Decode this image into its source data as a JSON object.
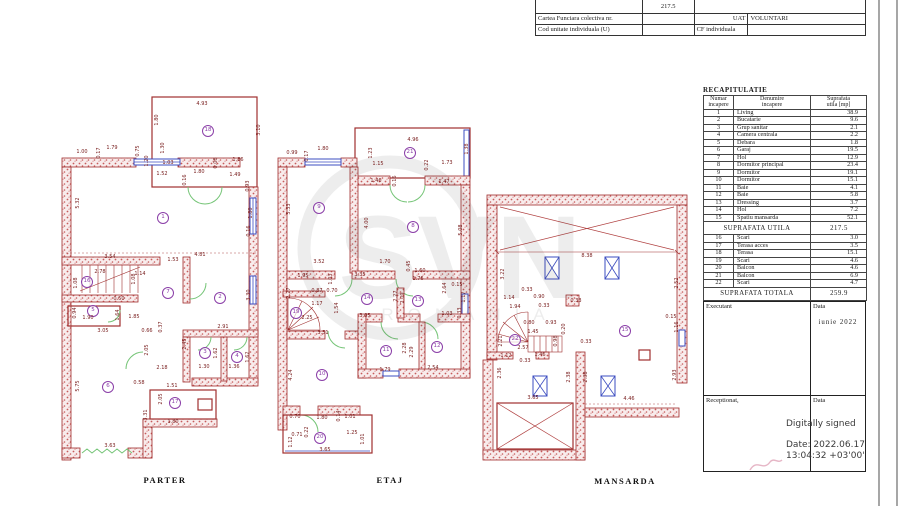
{
  "watermark": {
    "main": "SVN",
    "sub": "ROMANIA"
  },
  "top_table": {
    "area_value": "217.5",
    "row2": {
      "label": "Cartea Funciara colectiva nr.",
      "col2": "",
      "col3": "UAT",
      "col4": "VOLUNTARI"
    },
    "row3": {
      "label": "Cod unitate individuala (U)",
      "col2": "",
      "col3": "CF individuala",
      "col4": ""
    }
  },
  "recap": {
    "title": "RECAPITULATIE",
    "headers": [
      {
        "l1": "Numar",
        "l2": "incapere"
      },
      {
        "l1": "Denumire",
        "l2": "incapere"
      },
      {
        "l1": "Suprafata",
        "l2": "utila [mp]"
      }
    ],
    "rows": [
      [
        "1",
        "Living",
        "38.9"
      ],
      [
        "2",
        "Bucatarie",
        "9.6"
      ],
      [
        "3",
        "Grup sanitar",
        "2.1"
      ],
      [
        "4",
        "Camera centrala",
        "2.2"
      ],
      [
        "5",
        "Debara",
        "1.8"
      ],
      [
        "6",
        "Garaj",
        "19.5"
      ],
      [
        "7",
        "Hol",
        "12.9"
      ],
      [
        "8",
        "Dormitor principal",
        "23.4"
      ],
      [
        "9",
        "Dormitor",
        "19.1"
      ],
      [
        "10",
        "Dormitor",
        "15.1"
      ],
      [
        "11",
        "Baie",
        "4.1"
      ],
      [
        "12",
        "Baie",
        "5.8"
      ],
      [
        "13",
        "Dressing",
        "3.7"
      ],
      [
        "14",
        "Hol",
        "7.2"
      ],
      [
        "15",
        "Spatiu mansarda",
        "52.1"
      ]
    ],
    "subtotal_label": "SUPRAFATA UTILA",
    "subtotal_value": "217.5",
    "rows2": [
      [
        "16",
        "Scari",
        "3.0"
      ],
      [
        "17",
        "Terasa acces",
        "3.5"
      ],
      [
        "18",
        "Terasa",
        "15.1"
      ],
      [
        "19",
        "Scari",
        "4.6"
      ],
      [
        "20",
        "Balcon",
        "4.6"
      ],
      [
        "21",
        "Balcon",
        "6.9"
      ],
      [
        "22",
        "Scari",
        "4.7"
      ]
    ],
    "total_label": "SUPRAFATA TOTALA",
    "total_value": "259.9",
    "executant_label": "Executant",
    "data_label": "Data",
    "date_value": "iunie 2022",
    "receptionat_label": "Receptionat,",
    "data_label2": "Data",
    "signature": {
      "line1": "Digitally signed",
      "line2": "Date: 2022.06.17",
      "line3": "13:04:32 +03'00'"
    }
  },
  "plans": [
    {
      "label": "PARTER",
      "x": 165,
      "y": 480,
      "rooms": [
        {
          "n": "18",
          "x": 208,
          "y": 131
        },
        {
          "n": "1",
          "x": 163,
          "y": 218
        },
        {
          "n": "16",
          "x": 87,
          "y": 282
        },
        {
          "n": "7",
          "x": 168,
          "y": 293
        },
        {
          "n": "2",
          "x": 220,
          "y": 298
        },
        {
          "n": "5",
          "x": 93,
          "y": 311
        },
        {
          "n": "3",
          "x": 205,
          "y": 353
        },
        {
          "n": "4",
          "x": 237,
          "y": 357
        },
        {
          "n": "6",
          "x": 108,
          "y": 387
        },
        {
          "n": "17",
          "x": 175,
          "y": 403
        }
      ],
      "dims": [
        {
          "t": "4.93",
          "x": 202,
          "y": 104
        },
        {
          "t": "1.80",
          "x": 157,
          "y": 120,
          "r": 1
        },
        {
          "t": "3.10",
          "x": 259,
          "y": 130,
          "r": 1
        },
        {
          "t": "1.00",
          "x": 82,
          "y": 152
        },
        {
          "t": "1.79",
          "x": 112,
          "y": 148
        },
        {
          "t": "0.17",
          "x": 99,
          "y": 153,
          "r": 1
        },
        {
          "t": "0.75",
          "x": 138,
          "y": 151,
          "r": 1
        },
        {
          "t": "1.30",
          "x": 163,
          "y": 148,
          "r": 1
        },
        {
          "t": "1.20",
          "x": 147,
          "y": 161,
          "r": 1
        },
        {
          "t": "1.03",
          "x": 168,
          "y": 163
        },
        {
          "t": "1.52",
          "x": 162,
          "y": 174
        },
        {
          "t": "0.16",
          "x": 185,
          "y": 180,
          "r": 1
        },
        {
          "t": "1.80",
          "x": 199,
          "y": 172
        },
        {
          "t": "0.08",
          "x": 216,
          "y": 163,
          "r": 1
        },
        {
          "t": "1.86",
          "x": 238,
          "y": 160
        },
        {
          "t": "1.49",
          "x": 235,
          "y": 175
        },
        {
          "t": "0.93",
          "x": 248,
          "y": 186,
          "r": 1
        },
        {
          "t": "1.80",
          "x": 251,
          "y": 213,
          "r": 1
        },
        {
          "t": "0.16",
          "x": 249,
          "y": 231,
          "r": 1
        },
        {
          "t": "5.32",
          "x": 78,
          "y": 203,
          "r": 1
        },
        {
          "t": "3.54",
          "x": 110,
          "y": 257
        },
        {
          "t": "1.53",
          "x": 173,
          "y": 260
        },
        {
          "t": "4.81",
          "x": 200,
          "y": 255
        },
        {
          "t": "2.78",
          "x": 100,
          "y": 272
        },
        {
          "t": "1.14",
          "x": 140,
          "y": 274
        },
        {
          "t": "1.08",
          "x": 76,
          "y": 283,
          "r": 1
        },
        {
          "t": "1.08",
          "x": 134,
          "y": 279,
          "r": 1
        },
        {
          "t": "0.50",
          "x": 119,
          "y": 299
        },
        {
          "t": "3.30",
          "x": 249,
          "y": 295,
          "r": 1
        },
        {
          "t": "0.94",
          "x": 75,
          "y": 313,
          "r": 1
        },
        {
          "t": "1.90",
          "x": 88,
          "y": 318
        },
        {
          "t": "1.64",
          "x": 118,
          "y": 315,
          "r": 1
        },
        {
          "t": "1.85",
          "x": 134,
          "y": 317
        },
        {
          "t": "0.66",
          "x": 147,
          "y": 331
        },
        {
          "t": "0.37",
          "x": 161,
          "y": 327,
          "r": 1
        },
        {
          "t": "3.05",
          "x": 103,
          "y": 331
        },
        {
          "t": "2.05",
          "x": 147,
          "y": 350,
          "r": 1
        },
        {
          "t": "2.45",
          "x": 185,
          "y": 344,
          "r": 1
        },
        {
          "t": "2.91",
          "x": 223,
          "y": 327
        },
        {
          "t": "1.62",
          "x": 216,
          "y": 353,
          "r": 1
        },
        {
          "t": "1.62",
          "x": 248,
          "y": 357,
          "r": 1
        },
        {
          "t": "1.30",
          "x": 204,
          "y": 367
        },
        {
          "t": "1.36",
          "x": 234,
          "y": 367
        },
        {
          "t": "2.18",
          "x": 162,
          "y": 368
        },
        {
          "t": "0.58",
          "x": 139,
          "y": 383
        },
        {
          "t": "1.51",
          "x": 172,
          "y": 386
        },
        {
          "t": "5.75",
          "x": 78,
          "y": 386,
          "r": 1
        },
        {
          "t": "2.05",
          "x": 161,
          "y": 399,
          "r": 1
        },
        {
          "t": "3.31",
          "x": 146,
          "y": 415,
          "r": 1
        },
        {
          "t": "1.80",
          "x": 173,
          "y": 422
        },
        {
          "t": "3.63",
          "x": 110,
          "y": 446
        }
      ]
    },
    {
      "label": "ETAJ",
      "x": 390,
      "y": 480,
      "rooms": [
        {
          "n": "21",
          "x": 410,
          "y": 153
        },
        {
          "n": "9",
          "x": 319,
          "y": 208
        },
        {
          "n": "8",
          "x": 413,
          "y": 227
        },
        {
          "n": "14",
          "x": 367,
          "y": 299
        },
        {
          "n": "13",
          "x": 418,
          "y": 301
        },
        {
          "n": "19",
          "x": 296,
          "y": 313
        },
        {
          "n": "11",
          "x": 386,
          "y": 351
        },
        {
          "n": "12",
          "x": 437,
          "y": 347
        },
        {
          "n": "10",
          "x": 322,
          "y": 375
        },
        {
          "n": "20",
          "x": 320,
          "y": 438
        }
      ],
      "dims": [
        {
          "t": "4.96",
          "x": 413,
          "y": 140
        },
        {
          "t": "1.38",
          "x": 467,
          "y": 149,
          "r": 1
        },
        {
          "t": "0.99",
          "x": 292,
          "y": 153
        },
        {
          "t": "0.17",
          "x": 307,
          "y": 156,
          "r": 1
        },
        {
          "t": "1.80",
          "x": 323,
          "y": 149
        },
        {
          "t": "1.23",
          "x": 371,
          "y": 153,
          "r": 1
        },
        {
          "t": "1.15",
          "x": 378,
          "y": 164
        },
        {
          "t": "0.16",
          "x": 395,
          "y": 181,
          "r": 1
        },
        {
          "t": "0.22",
          "x": 427,
          "y": 165,
          "r": 1
        },
        {
          "t": "1.73",
          "x": 447,
          "y": 163
        },
        {
          "t": "1.46",
          "x": 376,
          "y": 181
        },
        {
          "t": "1.47",
          "x": 444,
          "y": 182
        },
        {
          "t": "5.33",
          "x": 289,
          "y": 209,
          "r": 1
        },
        {
          "t": "4.00",
          "x": 367,
          "y": 223,
          "r": 1
        },
        {
          "t": "5.08",
          "x": 461,
          "y": 230,
          "r": 1
        },
        {
          "t": "3.52",
          "x": 319,
          "y": 262
        },
        {
          "t": "1.70",
          "x": 385,
          "y": 262
        },
        {
          "t": "0.45",
          "x": 409,
          "y": 266,
          "r": 1
        },
        {
          "t": "1.60",
          "x": 420,
          "y": 271
        },
        {
          "t": "1.76",
          "x": 418,
          "y": 279
        },
        {
          "t": "3.35",
          "x": 360,
          "y": 275
        },
        {
          "t": "1.95",
          "x": 303,
          "y": 276
        },
        {
          "t": "1.03",
          "x": 331,
          "y": 279,
          "r": 1
        },
        {
          "t": "0.87",
          "x": 317,
          "y": 291
        },
        {
          "t": "0.70",
          "x": 332,
          "y": 291
        },
        {
          "t": "1.17",
          "x": 317,
          "y": 304
        },
        {
          "t": "1.54",
          "x": 337,
          "y": 308,
          "r": 1
        },
        {
          "t": "2.25",
          "x": 307,
          "y": 318
        },
        {
          "t": "3.05",
          "x": 365,
          "y": 316
        },
        {
          "t": "3.51",
          "x": 323,
          "y": 333
        },
        {
          "t": "2.27",
          "x": 289,
          "y": 293,
          "r": 1
        },
        {
          "t": "2.27",
          "x": 396,
          "y": 296,
          "r": 1
        },
        {
          "t": "2.09",
          "x": 403,
          "y": 298,
          "r": 1
        },
        {
          "t": "2.64",
          "x": 445,
          "y": 288,
          "r": 1
        },
        {
          "t": "0.15",
          "x": 457,
          "y": 285
        },
        {
          "t": "1.17",
          "x": 464,
          "y": 297,
          "r": 1
        },
        {
          "t": "1.03",
          "x": 447,
          "y": 314
        },
        {
          "t": "0.33",
          "x": 460,
          "y": 313,
          "r": 1
        },
        {
          "t": "2.28",
          "x": 405,
          "y": 348,
          "r": 1
        },
        {
          "t": "2.29",
          "x": 412,
          "y": 352,
          "r": 1
        },
        {
          "t": "4.24",
          "x": 291,
          "y": 375,
          "r": 1
        },
        {
          "t": "1.79",
          "x": 385,
          "y": 370
        },
        {
          "t": "2.54",
          "x": 433,
          "y": 368
        },
        {
          "t": "0.70",
          "x": 295,
          "y": 417
        },
        {
          "t": "1.80",
          "x": 322,
          "y": 418
        },
        {
          "t": "0.14",
          "x": 339,
          "y": 416,
          "r": 1
        },
        {
          "t": "1.01",
          "x": 350,
          "y": 417
        },
        {
          "t": "0.22",
          "x": 307,
          "y": 432,
          "r": 1
        },
        {
          "t": "0.71",
          "x": 297,
          "y": 435
        },
        {
          "t": "1.12",
          "x": 291,
          "y": 442,
          "r": 1
        },
        {
          "t": "1.25",
          "x": 352,
          "y": 433
        },
        {
          "t": "1.01",
          "x": 363,
          "y": 439,
          "r": 1
        },
        {
          "t": "3.65",
          "x": 325,
          "y": 450
        }
      ]
    },
    {
      "label": "MANSARDA",
      "x": 625,
      "y": 481,
      "rooms": [
        {
          "n": "15",
          "x": 625,
          "y": 331
        },
        {
          "n": "22",
          "x": 515,
          "y": 340
        }
      ],
      "dims": [
        {
          "t": "8.38",
          "x": 587,
          "y": 256
        },
        {
          "t": "3.22",
          "x": 503,
          "y": 274,
          "r": 1
        },
        {
          "t": "2.52",
          "x": 677,
          "y": 283,
          "r": 1
        },
        {
          "t": "1.14",
          "x": 509,
          "y": 298
        },
        {
          "t": "0.33",
          "x": 527,
          "y": 290
        },
        {
          "t": "0.90",
          "x": 539,
          "y": 297
        },
        {
          "t": "1.94",
          "x": 515,
          "y": 307
        },
        {
          "t": "0.33",
          "x": 544,
          "y": 306
        },
        {
          "t": "0.33",
          "x": 576,
          "y": 301
        },
        {
          "t": "0.15",
          "x": 671,
          "y": 317
        },
        {
          "t": "1.16",
          "x": 677,
          "y": 327,
          "r": 1
        },
        {
          "t": "0.80",
          "x": 529,
          "y": 323
        },
        {
          "t": "0.93",
          "x": 551,
          "y": 323
        },
        {
          "t": "1.45",
          "x": 533,
          "y": 332
        },
        {
          "t": "0.20",
          "x": 564,
          "y": 329,
          "r": 1
        },
        {
          "t": "0.98",
          "x": 556,
          "y": 341,
          "r": 1
        },
        {
          "t": "2.21",
          "x": 501,
          "y": 341,
          "r": 1
        },
        {
          "t": "2.57",
          "x": 523,
          "y": 348
        },
        {
          "t": "1.12",
          "x": 506,
          "y": 356
        },
        {
          "t": "0.33",
          "x": 525,
          "y": 361
        },
        {
          "t": "1.46",
          "x": 540,
          "y": 355
        },
        {
          "t": "0.33",
          "x": 586,
          "y": 342
        },
        {
          "t": "2.36",
          "x": 500,
          "y": 373,
          "r": 1
        },
        {
          "t": "2.38",
          "x": 569,
          "y": 377,
          "r": 1
        },
        {
          "t": "2.38",
          "x": 586,
          "y": 377,
          "r": 1
        },
        {
          "t": "2.93",
          "x": 675,
          "y": 375,
          "r": 1
        },
        {
          "t": "3.65",
          "x": 533,
          "y": 398
        },
        {
          "t": "4.46",
          "x": 629,
          "y": 399
        }
      ]
    }
  ]
}
